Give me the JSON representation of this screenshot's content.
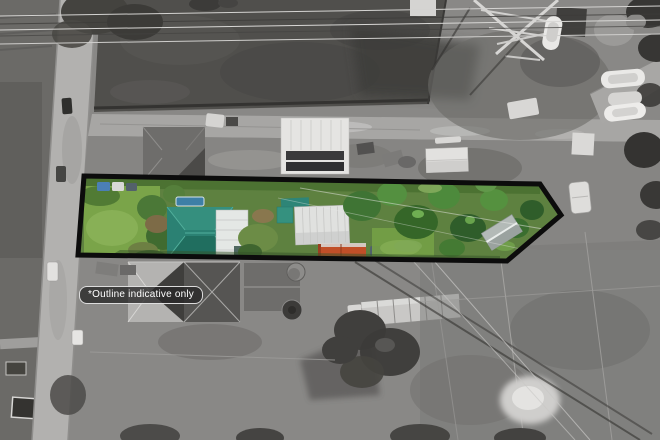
{
  "badge": {
    "label": "*Outline indicative only"
  },
  "property": {
    "outline_points": "84,176 540,184 561,215 507,261 78,255"
  },
  "colors": {
    "outline_stroke": "#0c0c0c",
    "badge_background": "#282828",
    "badge_border": "#fafafa",
    "badge_text": "#ffffff",
    "lawn_green": "#7aa449",
    "foliage_green": "#4a7437",
    "house_roof_teal": "#2b8173",
    "shed_roof_white": "#e0e1df",
    "container_orange": "#c14f28",
    "pool_blue": "#3e7fa6",
    "background_gray": "#898886",
    "road_gray": "#b2b1af",
    "paddock_dark_gray": "#504f4c"
  }
}
